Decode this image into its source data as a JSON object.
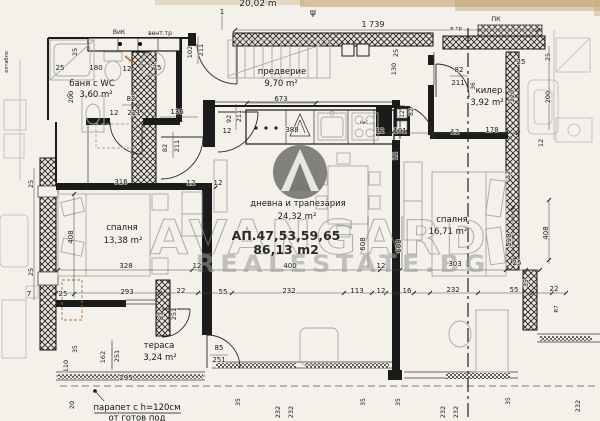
{
  "meta": {
    "drawing_type": "apartment floor plan scan",
    "language": "bg"
  },
  "header": {
    "partial_scale_text": "20,02 m",
    "overall_width_dim": "1 739"
  },
  "watermark": {
    "brand": "AVANGARD",
    "domain": "REALESTATE.BG",
    "logo": "mountain-triangle-in-circle"
  },
  "apartment": {
    "label": "АП.47,53,59,65",
    "total_area": "86,13 m2"
  },
  "rooms": [
    {
      "name": "баня с WC",
      "prefix": "пс",
      "area": "3,60 m²"
    },
    {
      "name": "предверие",
      "area": "9,70 m²"
    },
    {
      "name": "килер",
      "area": "3,92 m²"
    },
    {
      "name": "дневна и трапезария",
      "area": "24,32 m²"
    },
    {
      "name": "спалня",
      "area": "13,38 m²"
    },
    {
      "name": "спалня",
      "area": "16,71 m²"
    },
    {
      "name": "тераса",
      "area": "3,24 m²"
    }
  ],
  "notes": {
    "parapet_line1": "парапет с h=120см",
    "parapet_line2": "от готов под"
  },
  "colors": {
    "paper": "#f3f1ea",
    "ink": "#1b1b1b",
    "watermark_gray": "#8d8d8d",
    "logo_gray": "#6d6d6d",
    "scan_edge_tan": "#c9ae82",
    "pen_mark_orange": "#c87a3a"
  },
  "annotations": [
    {
      "t": "20,02 m",
      "x": 258,
      "y": 6,
      "s": 9,
      "c": "#8a8578"
    },
    {
      "t": "ψ",
      "x": 313,
      "y": 15,
      "s": 9,
      "c": "#8a8578"
    },
    {
      "t": "1",
      "x": 222,
      "y": 14,
      "s": 7,
      "c": "#555555"
    },
    {
      "t": "1 739",
      "x": 373,
      "y": 27,
      "s": 8
    },
    {
      "t": "в.тр.",
      "x": 457,
      "y": 30,
      "s": 5.5
    },
    {
      "t": "ПК",
      "x": 496,
      "y": 21,
      "s": 6.5
    },
    {
      "t": "ВиК",
      "x": 119,
      "y": 34,
      "s": 6
    },
    {
      "t": "вент.тр",
      "x": 160,
      "y": 35,
      "s": 6
    },
    {
      "t": "елтабло",
      "x": 8,
      "y": 62,
      "r": 1,
      "s": 5,
      "c": "#555555"
    },
    {
      "t": "102",
      "x": 192,
      "y": 52,
      "r": 1,
      "s": 6.5
    },
    {
      "t": "211",
      "x": 203,
      "y": 50,
      "r": 1,
      "s": 6.5
    },
    {
      "t": "25",
      "x": 77,
      "y": 52,
      "r": 1,
      "s": 6.5
    },
    {
      "t": "25",
      "x": 60,
      "y": 70
    },
    {
      "t": "180",
      "x": 96,
      "y": 70
    },
    {
      "t": "12",
      "x": 127,
      "y": 71
    },
    {
      "t": "75",
      "x": 157,
      "y": 70
    },
    {
      "t": "200",
      "x": 73,
      "y": 97,
      "r": 1,
      "s": 6.5
    },
    {
      "t": "82",
      "x": 131,
      "y": 101
    },
    {
      "t": "12",
      "x": 114,
      "y": 115
    },
    {
      "t": "211",
      "x": 134,
      "y": 115
    },
    {
      "t": "136",
      "x": 177,
      "y": 114
    },
    {
      "t": "92",
      "x": 231,
      "y": 119,
      "r": 1,
      "s": 6.5
    },
    {
      "t": "211",
      "x": 241,
      "y": 116,
      "r": 1,
      "s": 6.5
    },
    {
      "t": "12",
      "x": 227,
      "y": 133
    },
    {
      "t": "82",
      "x": 167,
      "y": 148,
      "r": 1,
      "s": 6.5
    },
    {
      "t": "211",
      "x": 179,
      "y": 146,
      "r": 1,
      "s": 6.5
    },
    {
      "t": "673",
      "x": 281,
      "y": 101
    },
    {
      "t": "388",
      "x": 292,
      "y": 132
    },
    {
      "t": "НиС",
      "x": 364,
      "y": 124,
      "s": 4
    },
    {
      "t": "25",
      "x": 398,
      "y": 53,
      "r": 1,
      "s": 6.5
    },
    {
      "t": "130",
      "x": 396,
      "y": 69,
      "r": 1,
      "s": 6.5
    },
    {
      "t": "12",
      "x": 404,
      "y": 114,
      "r": 1,
      "s": 6
    },
    {
      "t": "82",
      "x": 413,
      "y": 112,
      "r": 1,
      "s": 6
    },
    {
      "t": "12",
      "x": 380,
      "y": 133
    },
    {
      "t": "101",
      "x": 400,
      "y": 133
    },
    {
      "t": "12",
      "x": 455,
      "y": 134
    },
    {
      "t": "178",
      "x": 492,
      "y": 132
    },
    {
      "t": "82",
      "x": 459,
      "y": 72
    },
    {
      "t": "211",
      "x": 458,
      "y": 85
    },
    {
      "t": "36",
      "x": 475,
      "y": 86,
      "r": 1,
      "s": 6
    },
    {
      "t": "25",
      "x": 521,
      "y": 64
    },
    {
      "t": "220",
      "x": 514,
      "y": 96,
      "r": 1,
      "s": 6.5
    },
    {
      "t": "25",
      "x": 550,
      "y": 57,
      "r": 1,
      "s": 6.5
    },
    {
      "t": "200",
      "x": 550,
      "y": 97,
      "r": 1,
      "s": 6.5
    },
    {
      "t": "12",
      "x": 543,
      "y": 143,
      "r": 1,
      "s": 6.5
    },
    {
      "t": "12",
      "x": 510,
      "y": 175,
      "r": 1,
      "s": 6.5
    },
    {
      "t": "12",
      "x": 397,
      "y": 156,
      "r": 1,
      "s": 6.5
    },
    {
      "t": "316",
      "x": 121,
      "y": 184
    },
    {
      "t": "12",
      "x": 191,
      "y": 185
    },
    {
      "t": "12",
      "x": 218,
      "y": 185
    },
    {
      "t": "408",
      "x": 73,
      "y": 237,
      "r": 1
    },
    {
      "t": "25",
      "x": 33,
      "y": 184,
      "r": 1,
      "s": 6.5
    },
    {
      "t": "25",
      "x": 33,
      "y": 272,
      "r": 1,
      "s": 6.5
    },
    {
      "t": "328",
      "x": 126,
      "y": 268
    },
    {
      "t": "12",
      "x": 197,
      "y": 268
    },
    {
      "t": "400",
      "x": 290,
      "y": 268
    },
    {
      "t": "12",
      "x": 381,
      "y": 268
    },
    {
      "t": "303",
      "x": 455,
      "y": 266
    },
    {
      "t": "25",
      "x": 517,
      "y": 265
    },
    {
      "t": "608",
      "x": 365,
      "y": 244,
      "r": 1
    },
    {
      "t": "608",
      "x": 401,
      "y": 246,
      "r": 1
    },
    {
      "t": "518",
      "x": 511,
      "y": 240,
      "r": 1
    },
    {
      "t": "408",
      "x": 548,
      "y": 233,
      "r": 1
    },
    {
      "t": "293",
      "x": 127,
      "y": 294
    },
    {
      "t": "7",
      "x": 29,
      "y": 296
    },
    {
      "t": "25",
      "x": 63,
      "y": 296
    },
    {
      "t": "22",
      "x": 181,
      "y": 293
    },
    {
      "t": "55",
      "x": 223,
      "y": 294
    },
    {
      "t": "232",
      "x": 289,
      "y": 293
    },
    {
      "t": "113",
      "x": 357,
      "y": 293
    },
    {
      "t": "12",
      "x": 381,
      "y": 293
    },
    {
      "t": "16",
      "x": 407,
      "y": 293
    },
    {
      "t": "232",
      "x": 453,
      "y": 292
    },
    {
      "t": "55",
      "x": 514,
      "y": 292
    },
    {
      "t": "22",
      "x": 554,
      "y": 291
    },
    {
      "t": "35",
      "x": 528,
      "y": 283,
      "r": 1,
      "s": 6
    },
    {
      "t": "R7",
      "x": 558,
      "y": 309,
      "r": 1,
      "s": 5.5
    },
    {
      "t": "87",
      "x": 163,
      "y": 316,
      "r": 1,
      "s": 6.5
    },
    {
      "t": "251",
      "x": 176,
      "y": 314,
      "r": 1,
      "s": 6.5
    },
    {
      "t": "85",
      "x": 219,
      "y": 350
    },
    {
      "t": "251",
      "x": 219,
      "y": 362
    },
    {
      "t": "162",
      "x": 105,
      "y": 357,
      "r": 1,
      "s": 6.5
    },
    {
      "t": "251",
      "x": 119,
      "y": 356,
      "r": 1,
      "s": 6.5
    },
    {
      "t": "35",
      "x": 77,
      "y": 349,
      "r": 1,
      "s": 6
    },
    {
      "t": "110",
      "x": 68,
      "y": 366,
      "r": 1,
      "s": 6.5
    },
    {
      "t": "295",
      "x": 126,
      "y": 380
    },
    {
      "t": "20",
      "x": 74,
      "y": 405,
      "r": 1,
      "s": 6.5
    },
    {
      "t": "35",
      "x": 240,
      "y": 402,
      "r": 1,
      "s": 6
    },
    {
      "t": "232",
      "x": 280,
      "y": 412,
      "r": 1,
      "s": 6.5
    },
    {
      "t": "232",
      "x": 293,
      "y": 412,
      "r": 1,
      "s": 6.5
    },
    {
      "t": "35",
      "x": 365,
      "y": 402,
      "r": 1,
      "s": 6
    },
    {
      "t": "35",
      "x": 400,
      "y": 402,
      "r": 1,
      "s": 6
    },
    {
      "t": "232",
      "x": 445,
      "y": 412,
      "r": 1,
      "s": 6.5
    },
    {
      "t": "232",
      "x": 458,
      "y": 412,
      "r": 1,
      "s": 6.5
    },
    {
      "t": "35",
      "x": 510,
      "y": 401,
      "r": 1,
      "s": 6
    },
    {
      "t": "232",
      "x": 580,
      "y": 406,
      "r": 1,
      "s": 6.5
    }
  ]
}
